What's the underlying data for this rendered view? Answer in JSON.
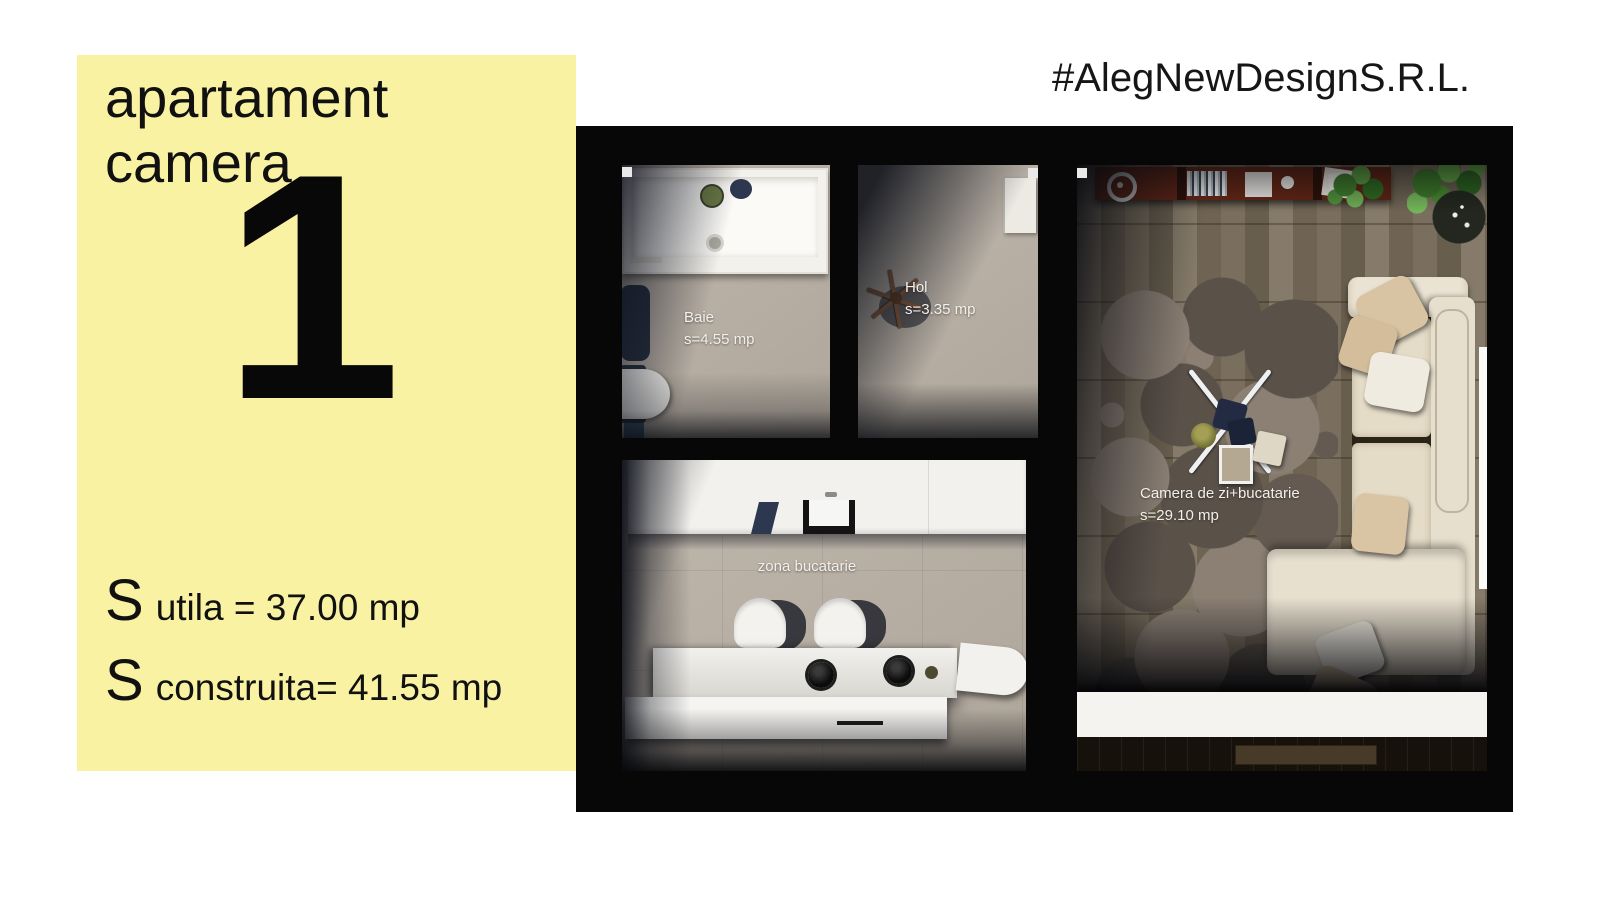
{
  "info_panel": {
    "title": "apartament camera",
    "apartment_number": "1",
    "surface_lines": [
      {
        "symbol": "S",
        "text": "utila = 37.00 mp"
      },
      {
        "symbol": "S",
        "text": "construita= 41.55 mp"
      }
    ]
  },
  "branding": {
    "text": "#AlegNewDesignS.R.L."
  },
  "floor_plan": {
    "rooms": [
      {
        "name": "Baie",
        "area": "s=4.55 mp"
      },
      {
        "name": "Hol",
        "area": "s=3.35 mp"
      },
      {
        "name": "zona bucatarie"
      },
      {
        "name": "Camera de zi+bucatarie",
        "area": "s=29.10 mp"
      }
    ]
  },
  "colors": {
    "highlight_yellow": "#f9f2a2",
    "wall_black": "#070708",
    "tile_floor": "#b8afa3",
    "wood_floor": "#7b705f",
    "sofa_cream": "#e7dfcd",
    "console_brown": "#6b2a17",
    "plant_green": "#4c8a34",
    "label_white": "#f3f0ea",
    "text_black": "#111111"
  }
}
